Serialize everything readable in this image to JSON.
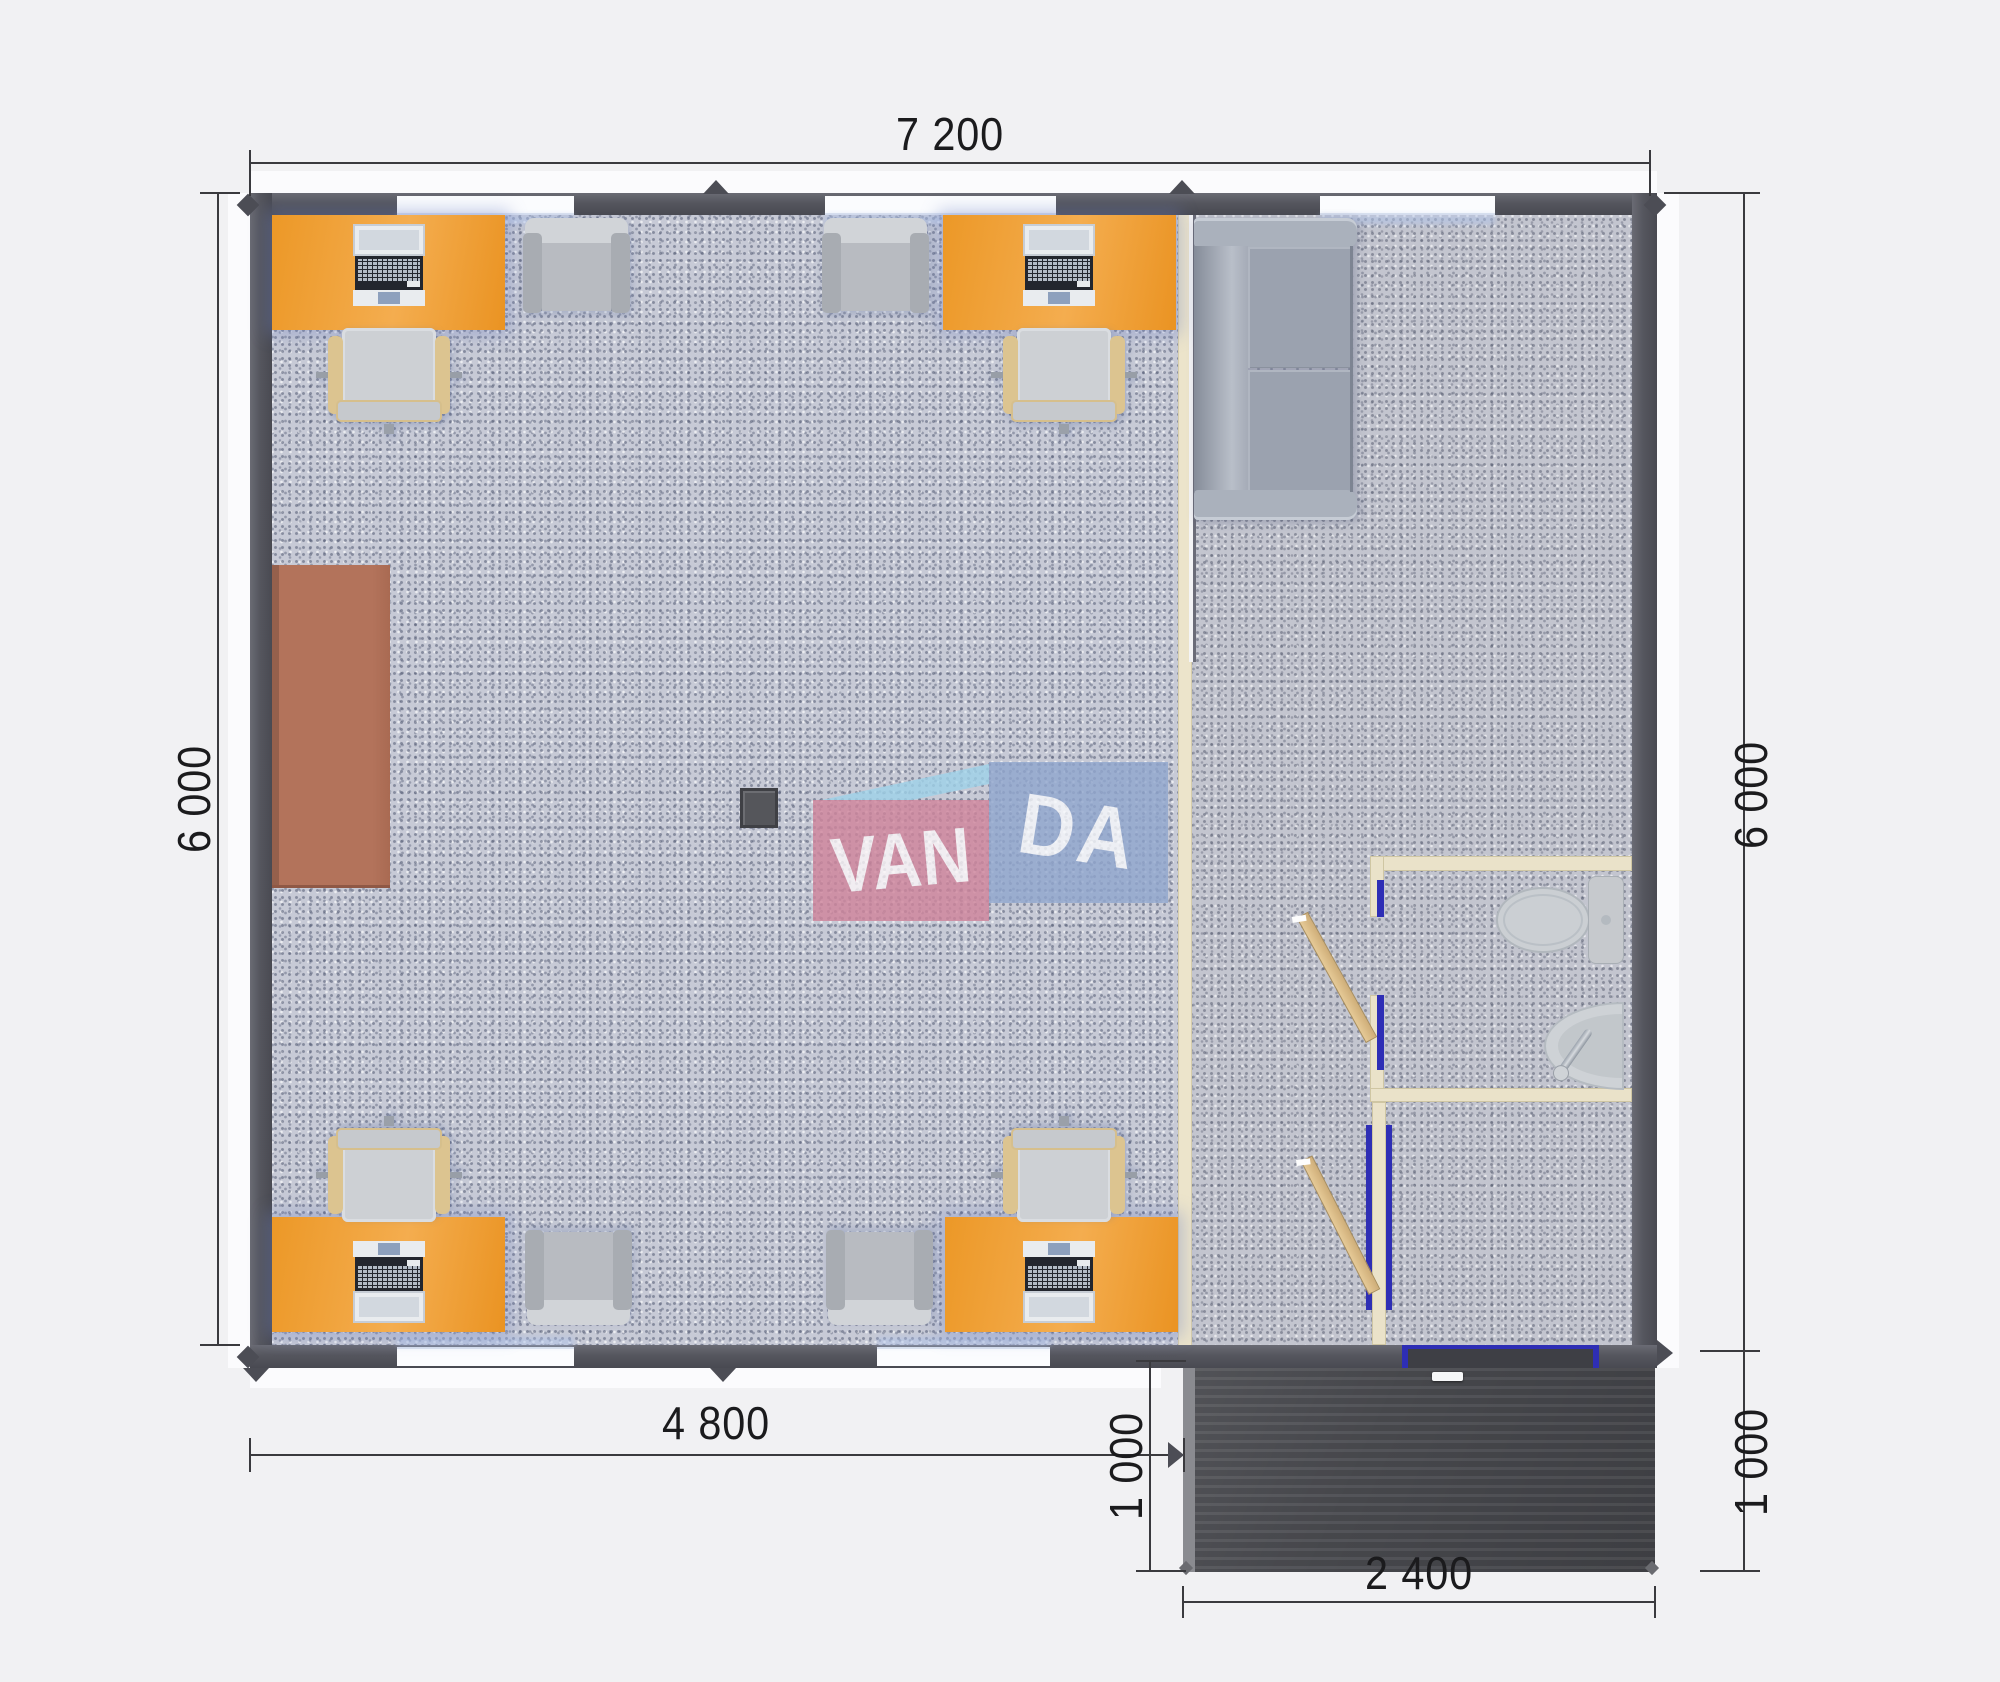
{
  "plan": {
    "dim_top": "7 200",
    "dim_left": "6 000",
    "dim_right": "6 000",
    "dim_bottom_left": "4 800",
    "dim_porch_left": "1 000",
    "dim_porch_right": "1 000",
    "dim_porch_bottom": "2 400"
  },
  "logo": {
    "van": "VAN",
    "da": "DA"
  },
  "colors": {
    "wall": "#55565e",
    "window_inner_frame_blue": "#3e3ec0",
    "desk_orange": "#f0a140",
    "carpet_office": "#c7cad6",
    "carpet_hall": "#c3c5cf",
    "partition_cream": "#ece4cb",
    "cabinet_brown": "#b3735b",
    "porch_dark": "#4a4b50",
    "door_leaf_tan": "#d8b887",
    "logo_pink": "#d0849b",
    "logo_blue": "#90a6ce",
    "logo_cyan": "#9fd2e9"
  }
}
